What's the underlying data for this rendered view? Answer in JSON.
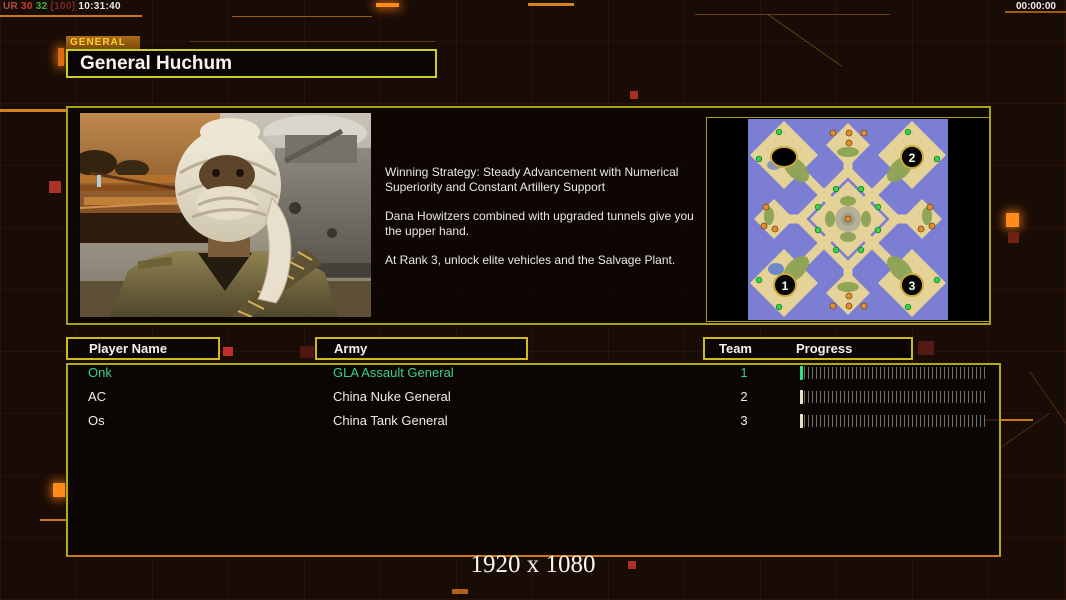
{
  "hud": {
    "debug": {
      "label": "UR",
      "v1": "30",
      "v2": "32",
      "v3": "[100]",
      "clock": "10:31:40"
    },
    "match_timer": "00:00:00"
  },
  "general_panel": {
    "tab_label": "GENERAL",
    "general_name": "General Huchum",
    "briefing": [
      "Winning Strategy: Steady Advancement with Numerical Superiority and Constant Artillery Support",
      "Dana Howitzers combined with upgraded tunnels give you the upper hand.",
      "At Rank 3, unlock elite vehicles and the Salvage Plant."
    ]
  },
  "minimap": {
    "positions": {
      "pos1": "1",
      "pos2": "2",
      "pos3": "3"
    }
  },
  "table": {
    "headers": {
      "player": "Player Name",
      "army": "Army",
      "team": "Team",
      "progress": "Progress"
    },
    "players": [
      {
        "name": "Onk",
        "army": "GLA Assault General",
        "team": "1",
        "text_color": "#3ecf87",
        "lead_color": "#2ee488"
      },
      {
        "name": "AC",
        "army": "China Nuke General",
        "team": "2",
        "text_color": "#ededed",
        "lead_color": "#e8e2c8"
      },
      {
        "name": "Os",
        "army": "China Tank General",
        "team": "3",
        "text_color": "#ededed",
        "lead_color": "#e8e2c8"
      }
    ]
  },
  "footer": {
    "resolution": "1920 x 1080"
  },
  "colors": {
    "accent_border_bright": "#c6d029",
    "accent_border_dim": "#a8a210",
    "orange_accent": "#ff8c1a",
    "local_player_green": "#3ecf87"
  }
}
